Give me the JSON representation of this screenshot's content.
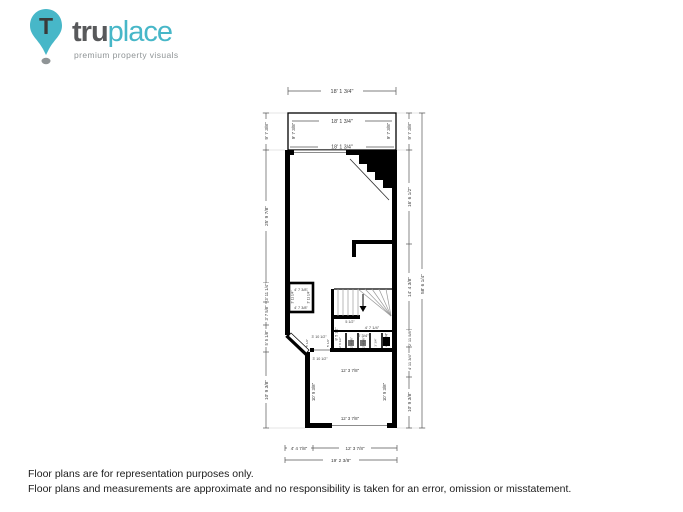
{
  "logo": {
    "brand_bold": "tru",
    "brand_light": "place",
    "tagline": "premium property visuals",
    "pin_letter": "T"
  },
  "footer": {
    "line1": "Floor plans are for representation purposes only.",
    "line2": "Floor plans and measurements are approximate and no responsibility is taken for an error, omission or misstatement."
  },
  "colors": {
    "accent_teal": "#47b7c8",
    "brand_gray": "#58595b",
    "wall_black": "#000000",
    "dim_gray": "#3a3a3a"
  },
  "plan": {
    "labels": {
      "top_overall": "18' 1 3/4\"",
      "deck_width": "18' 1 3/4\"",
      "deck_left": "9' 7 3/8\"",
      "deck_right": "9' 7 3/8\"",
      "main_top_width": "18' 1 3/4\"",
      "left_seg1": "9' 7 3/8\"",
      "left_seg2": "25' 9 7/8\"",
      "left_seg3": "3' 11 1/4\"",
      "left_seg4": "3' 7 5/8\"",
      "left_seg5": "5' 5 1/8\"",
      "left_seg6": "10' 9 3/8\"",
      "right_seg1": "9' 7 3/8\"",
      "right_seg2": "16' 6 1/2\"",
      "right_seg3": "14' 4 3/8\"",
      "right_seg4": "2' 11 5/8\"",
      "right_seg5": "4' 11 3/4\"",
      "right_seg6": "10' 9 3/8\"",
      "right_total": "58' 6 1/4\"",
      "closet_top": "4' 7 3/8\"",
      "closet_bottom": "4' 7 3/8\"",
      "closet_left": "3' 11 1/4\"",
      "closet_right": "3' 11 1/4\"",
      "stair_height": "8' 5 1/2\"",
      "stair_nose": "5 1/2\"",
      "stair_width": "4' 7 1/4\"",
      "stair_side": "4' 11 1/4\"",
      "hall_top": "3' 10 1/2\"",
      "hall_door": "3' 10 1/2\"",
      "hall_left": "5' 1/2\"",
      "hall_right": "5' 1/2\"",
      "bath_width": "8' 3/4\"",
      "bath_c1": "2' 8 1/2\"",
      "bath_c2": "2' 4 5/8\"",
      "bath_c3": "2' 4 5/8\"",
      "bath_c4": "3' 3/4\"",
      "room_top_width": "12' 3 7/8\"",
      "room_left": "10' 9 3/8\"",
      "room_right": "10' 9 3/8\"",
      "room_bottom_width": "12' 3 7/8\"",
      "bottom_seg1": "4' 4 7/8\"",
      "bottom_seg2": "12' 3 7/8\"",
      "bottom_total": "19' 2 3/8\""
    }
  }
}
